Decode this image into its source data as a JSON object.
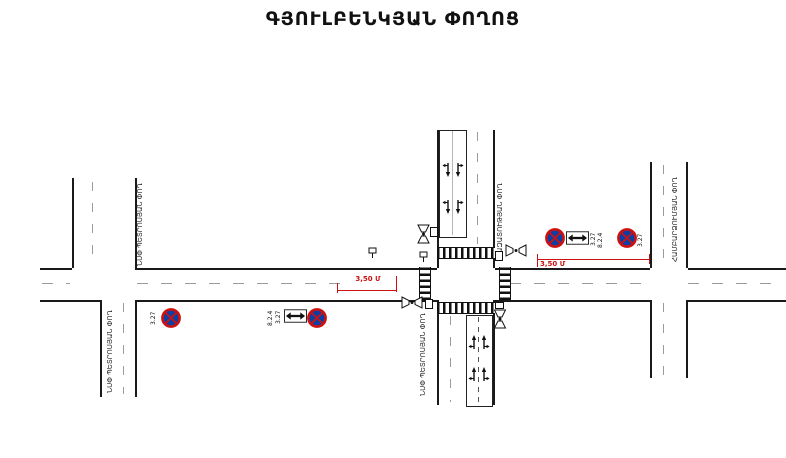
{
  "title": "ԳՅՈՒԼԲԵՆԿՅԱՆ ՓՈՂՈՑ",
  "streets": {
    "left_top": "ՆՍՓ ՊԵՏՐՈՍՅԱՆ ՓՈՂ",
    "left_bottom": "ՆՍՓ ՊԵՏՐՈՍՅԱՆ ՓՈՂ",
    "center_top": "ԱԶԱՏՈՒԹՅԱՆ ՓՈՂ",
    "center_bottom": "ՆՍՓ ՊԵՏՐՈՍՅԱՆ ՓՈՂ",
    "right": "ՀԱՄԲԱՐՁՈՒՄՅԱՆ ՓՈՂ"
  },
  "signs": {
    "west_single": {
      "code": "3.27"
    },
    "west_pair": {
      "code": "3.27",
      "plate": "8.2.4"
    },
    "east_pair": {
      "code": "3.27",
      "plate": "8.2.4"
    },
    "east_single": {
      "code": "3.27"
    }
  },
  "dimensions": {
    "west": "3,50 Մ",
    "east": "3,50 Մ"
  },
  "colors": {
    "sign_blue": "#0b3fa5",
    "sign_red": "#c11",
    "dimension_red": "#c11",
    "line_black": "#1a1a1a",
    "dash_gray": "#9b9b9b"
  }
}
